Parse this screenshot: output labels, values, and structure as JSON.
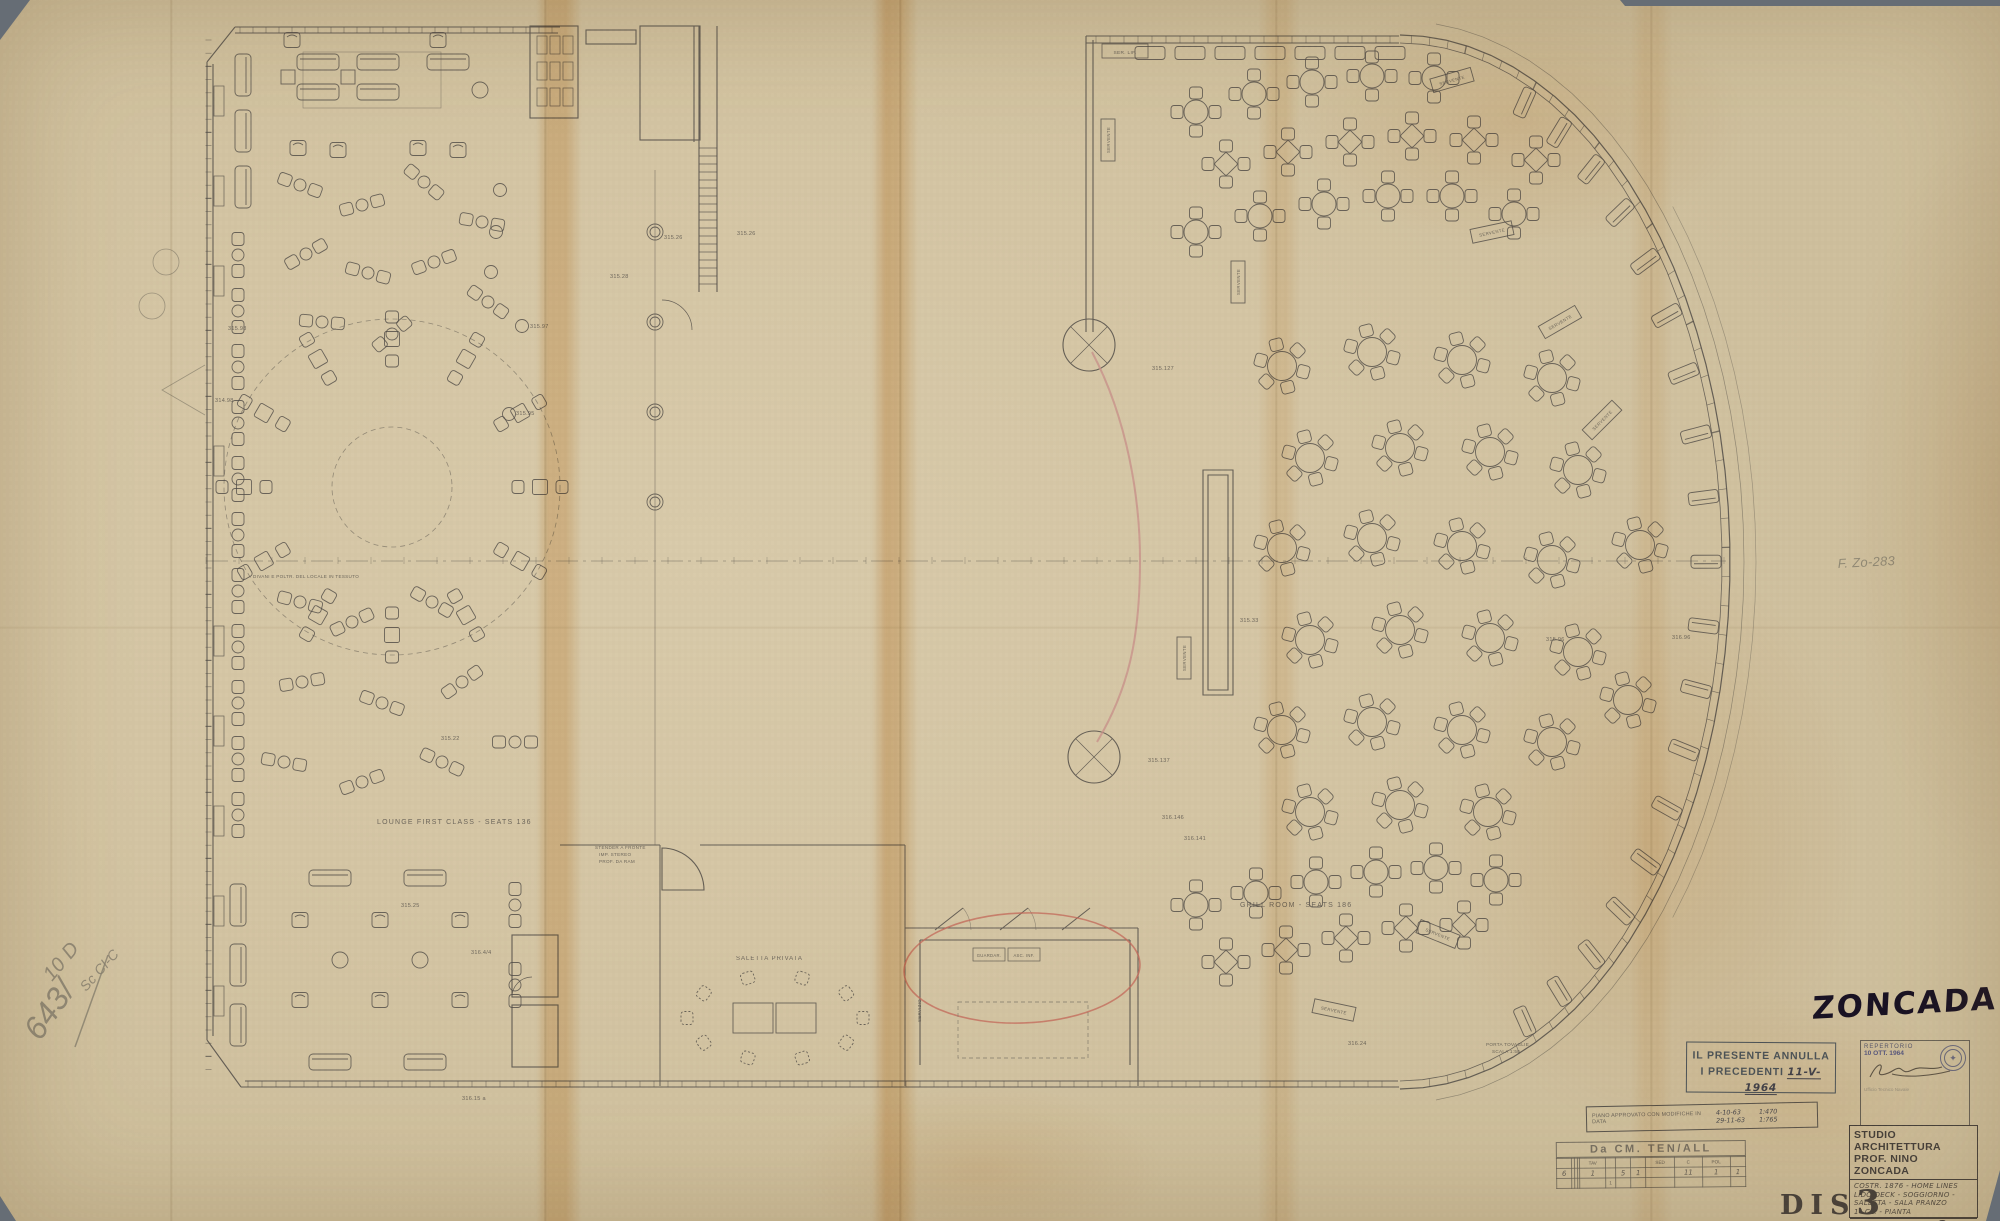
{
  "handwriting": {
    "zoncada": "ZONCADA",
    "file_ref": "F. Zo-283",
    "pencil_main": "643/",
    "pencil_main2": "10 D",
    "pencil_sub": "Sc Cl-C"
  },
  "cancel_stamp": {
    "line1": "IL PRESENTE ANNULLA",
    "line2": "I PRECEDENTI",
    "date": "11-V-1964"
  },
  "repertorio_stamp": {
    "line1": "REPERTORIO",
    "line2": "10 OTT. 1964",
    "sub": "Ufficio Tecnico Navale"
  },
  "approval_strip": {
    "text": "PIANO APPROVATO CON MODIFICHE IN DATA",
    "date_top": "4-10-63",
    "date_bottom": "29-11-63",
    "scale_top": "1:470",
    "scale_bottom": "1:765"
  },
  "cm_table": {
    "title": "Da CM. TEN/ALL",
    "headers": [
      "",
      "",
      "",
      "",
      "TAV",
      "",
      "",
      "",
      "SED",
      "C",
      "POL",
      ""
    ],
    "values": [
      "6",
      "",
      "",
      "",
      "1",
      "",
      "5",
      "1",
      "",
      "11",
      "1",
      "1"
    ],
    "row3": [
      "",
      "",
      "",
      "",
      "",
      "1",
      "",
      "",
      "",
      "",
      "",
      ""
    ]
  },
  "title_block": {
    "line1": "STUDIO ARCHITETTURA",
    "line2": "PROF. NINO ZONCADA",
    "desc": [
      "COSTR. 1876 - HOME LINES",
      "LIDO DECK - SOGGIORNO -",
      "SALETTA - SALA PRANZO",
      "1ª CL. -  PIANTA"
    ],
    "foot_label": "DATA",
    "foot_date": "1964",
    "foot_city": "ROMA",
    "foot_scale": "1:50",
    "foot_dis": "DIS. Nº",
    "foot_num": "3"
  },
  "dis_label": {
    "text": "DIS",
    "number": "3"
  },
  "colors": {
    "paper": "#d5c6a4",
    "ink": "#524d48",
    "pencil": "#87806f",
    "red": "#c4685a",
    "pink": "#c9928b",
    "stain": "#d89b3c"
  },
  "plan": {
    "annotations": [
      {
        "text": "LOUNGE FIRST CLASS    -    SEATS    136",
        "x": 377,
        "y": 824,
        "size": 7,
        "ls": 1.2
      },
      {
        "text": "GRILL ROOM   -   SEATS   186",
        "x": 1240,
        "y": 907,
        "size": 7,
        "ls": 1.2
      },
      {
        "text": "SALETTA PRIVATA",
        "x": 736,
        "y": 960,
        "size": 6,
        "ls": 1
      },
      {
        "text": "STENDER A FRONTE",
        "x": 595,
        "y": 849,
        "size": 4.6
      },
      {
        "text": "IMP. STEREO",
        "x": 599,
        "y": 856,
        "size": 4.6
      },
      {
        "text": "PROF. DA RAM",
        "x": 599,
        "y": 863,
        "size": 4.6
      },
      {
        "text": "DIVANI E POLTR. DEL LOCALE IN TESSUTO",
        "x": 253,
        "y": 578,
        "size": 4.6
      },
      {
        "text": "PORTA TOVAGLIE",
        "x": 1486,
        "y": 1046,
        "size": 4.6
      },
      {
        "text": "SCALA 1:50",
        "x": 1492,
        "y": 1053,
        "size": 4.6
      },
      {
        "text": "SER. LIF.",
        "x": 1125,
        "y": 54,
        "size": 4.8,
        "anchor": "middle"
      },
      {
        "text": "GUARDAR.",
        "x": 989,
        "y": 957,
        "size": 4.2,
        "anchor": "middle"
      },
      {
        "text": "ASC. INF.",
        "x": 1024,
        "y": 957,
        "size": 4.2,
        "anchor": "middle"
      },
      {
        "text": "SERVIZIO",
        "x": 921,
        "y": 1022,
        "size": 4.4,
        "rot": -90
      },
      {
        "text": "315.26",
        "x": 664,
        "y": 239
      },
      {
        "text": "315.26",
        "x": 737,
        "y": 235
      },
      {
        "text": "315.28",
        "x": 610,
        "y": 278
      },
      {
        "text": "315.98",
        "x": 228,
        "y": 330
      },
      {
        "text": "314.98",
        "x": 215,
        "y": 402
      },
      {
        "text": "315.97",
        "x": 530,
        "y": 328
      },
      {
        "text": "315.95",
        "x": 516,
        "y": 415
      },
      {
        "text": "315.22",
        "x": 441,
        "y": 740
      },
      {
        "text": "315.25",
        "x": 401,
        "y": 907
      },
      {
        "text": "316.4/4",
        "x": 471,
        "y": 954
      },
      {
        "text": "316.15 a",
        "x": 462,
        "y": 1100
      },
      {
        "text": "315.127",
        "x": 1152,
        "y": 370
      },
      {
        "text": "315.137",
        "x": 1148,
        "y": 762
      },
      {
        "text": "316.146",
        "x": 1162,
        "y": 819
      },
      {
        "text": "316.141",
        "x": 1184,
        "y": 840
      },
      {
        "text": "315.33",
        "x": 1240,
        "y": 622
      },
      {
        "text": "315.96",
        "x": 1546,
        "y": 641
      },
      {
        "text": "316.96",
        "x": 1672,
        "y": 639
      },
      {
        "text": "316.24",
        "x": 1348,
        "y": 1045
      },
      {
        "text": "F. Zo-283",
        "x": 1838,
        "y": 568,
        "size": 13,
        "style": "pencil",
        "rot": -3
      },
      {
        "text": "643/",
        "x": 40,
        "y": 1042,
        "size": 32,
        "style": "pencil",
        "rot": -55
      },
      {
        "text": "10 D",
        "x": 52,
        "y": 982,
        "size": 20,
        "style": "pencil",
        "rot": -50
      },
      {
        "text": "Sc Cl-C",
        "x": 86,
        "y": 992,
        "size": 14,
        "style": "pencil",
        "rot": -48
      }
    ],
    "serving_label": "SERVENTE",
    "serving_boxes": [
      [
        1108,
        140,
        -90
      ],
      [
        1238,
        282,
        -90
      ],
      [
        1452,
        80,
        -16
      ],
      [
        1492,
        232,
        -12
      ],
      [
        1560,
        322,
        -30
      ],
      [
        1602,
        420,
        -45
      ],
      [
        1184,
        658,
        -90
      ],
      [
        1438,
        934,
        22
      ],
      [
        1334,
        1010,
        12
      ]
    ],
    "furniture": {
      "pairs_wall": [
        [
          238,
          255
        ],
        [
          238,
          311
        ],
        [
          238,
          367
        ],
        [
          238,
          423
        ],
        [
          238,
          479
        ],
        [
          238,
          535
        ],
        [
          238,
          591
        ],
        [
          238,
          647
        ],
        [
          238,
          703
        ],
        [
          238,
          759
        ],
        [
          238,
          815
        ]
      ],
      "pairs_free": [
        [
          300,
          185,
          20
        ],
        [
          362,
          205,
          -15
        ],
        [
          424,
          182,
          40
        ],
        [
          482,
          222,
          10
        ],
        [
          306,
          254,
          -30
        ],
        [
          368,
          273,
          15
        ],
        [
          434,
          262,
          -20
        ],
        [
          488,
          302,
          35
        ],
        [
          322,
          322,
          5
        ],
        [
          392,
          334,
          -40
        ],
        [
          300,
          602,
          15
        ],
        [
          352,
          622,
          -25
        ],
        [
          432,
          602,
          30
        ],
        [
          302,
          682,
          -10
        ],
        [
          382,
          703,
          20
        ],
        [
          462,
          682,
          -35
        ],
        [
          284,
          762,
          10
        ],
        [
          362,
          782,
          -20
        ],
        [
          442,
          762,
          25
        ],
        [
          515,
          742,
          0
        ],
        [
          515,
          905,
          90
        ],
        [
          515,
          985,
          90
        ]
      ],
      "sofas_h": [
        [
          318,
          62
        ],
        [
          378,
          62
        ],
        [
          318,
          92
        ],
        [
          378,
          92
        ],
        [
          448,
          62
        ],
        [
          330,
          878
        ],
        [
          425,
          878
        ],
        [
          330,
          1062
        ],
        [
          425,
          1062
        ]
      ],
      "sofas_v": [
        [
          243,
          75
        ],
        [
          243,
          131
        ],
        [
          243,
          187
        ],
        [
          238,
          905
        ],
        [
          238,
          965
        ],
        [
          238,
          1025
        ]
      ],
      "arms": [
        [
          298,
          148
        ],
        [
          338,
          150
        ],
        [
          418,
          148
        ],
        [
          458,
          150
        ],
        [
          292,
          40
        ],
        [
          438,
          40
        ],
        [
          300,
          920
        ],
        [
          300,
          1000
        ],
        [
          380,
          920
        ],
        [
          380,
          1000
        ],
        [
          460,
          920
        ],
        [
          460,
          1000
        ]
      ],
      "tables_s": [
        [
          348,
          77
        ],
        [
          288,
          77
        ]
      ],
      "tables_r": [
        [
          340,
          960
        ],
        [
          420,
          960
        ],
        [
          480,
          90
        ]
      ],
      "stools": [
        [
          500,
          190
        ],
        [
          496,
          232
        ],
        [
          491,
          272
        ],
        [
          522,
          326
        ],
        [
          509,
          414
        ]
      ],
      "columns": [
        [
          655,
          232
        ],
        [
          655,
          322
        ],
        [
          655,
          412
        ],
        [
          655,
          502
        ]
      ],
      "grill_r6": [
        [
          1282,
          366
        ],
        [
          1372,
          352
        ],
        [
          1462,
          360
        ],
        [
          1552,
          378
        ],
        [
          1310,
          458
        ],
        [
          1400,
          448
        ],
        [
          1490,
          452
        ],
        [
          1578,
          470
        ],
        [
          1282,
          548
        ],
        [
          1372,
          538
        ],
        [
          1462,
          546
        ],
        [
          1552,
          560
        ],
        [
          1640,
          545
        ],
        [
          1310,
          640
        ],
        [
          1400,
          630
        ],
        [
          1490,
          638
        ],
        [
          1578,
          652
        ],
        [
          1282,
          730
        ],
        [
          1372,
          722
        ],
        [
          1462,
          730
        ],
        [
          1552,
          742
        ],
        [
          1628,
          700
        ],
        [
          1310,
          812
        ],
        [
          1400,
          805
        ],
        [
          1488,
          812
        ]
      ],
      "grill_r4": [
        [
          1196,
          112
        ],
        [
          1254,
          94
        ],
        [
          1312,
          82
        ],
        [
          1372,
          76
        ],
        [
          1434,
          78
        ],
        [
          1196,
          232
        ],
        [
          1260,
          216
        ],
        [
          1324,
          204
        ],
        [
          1388,
          196
        ],
        [
          1452,
          196
        ],
        [
          1514,
          214
        ],
        [
          1196,
          905
        ],
        [
          1256,
          893
        ],
        [
          1316,
          882
        ],
        [
          1376,
          872
        ],
        [
          1436,
          868
        ],
        [
          1496,
          880
        ]
      ],
      "grill_sq4": [
        [
          1226,
          164
        ],
        [
          1288,
          152
        ],
        [
          1350,
          142
        ],
        [
          1412,
          136
        ],
        [
          1474,
          140
        ],
        [
          1536,
          160
        ],
        [
          1226,
          962
        ],
        [
          1286,
          950
        ],
        [
          1346,
          938
        ],
        [
          1406,
          928
        ],
        [
          1464,
          925
        ]
      ]
    }
  }
}
